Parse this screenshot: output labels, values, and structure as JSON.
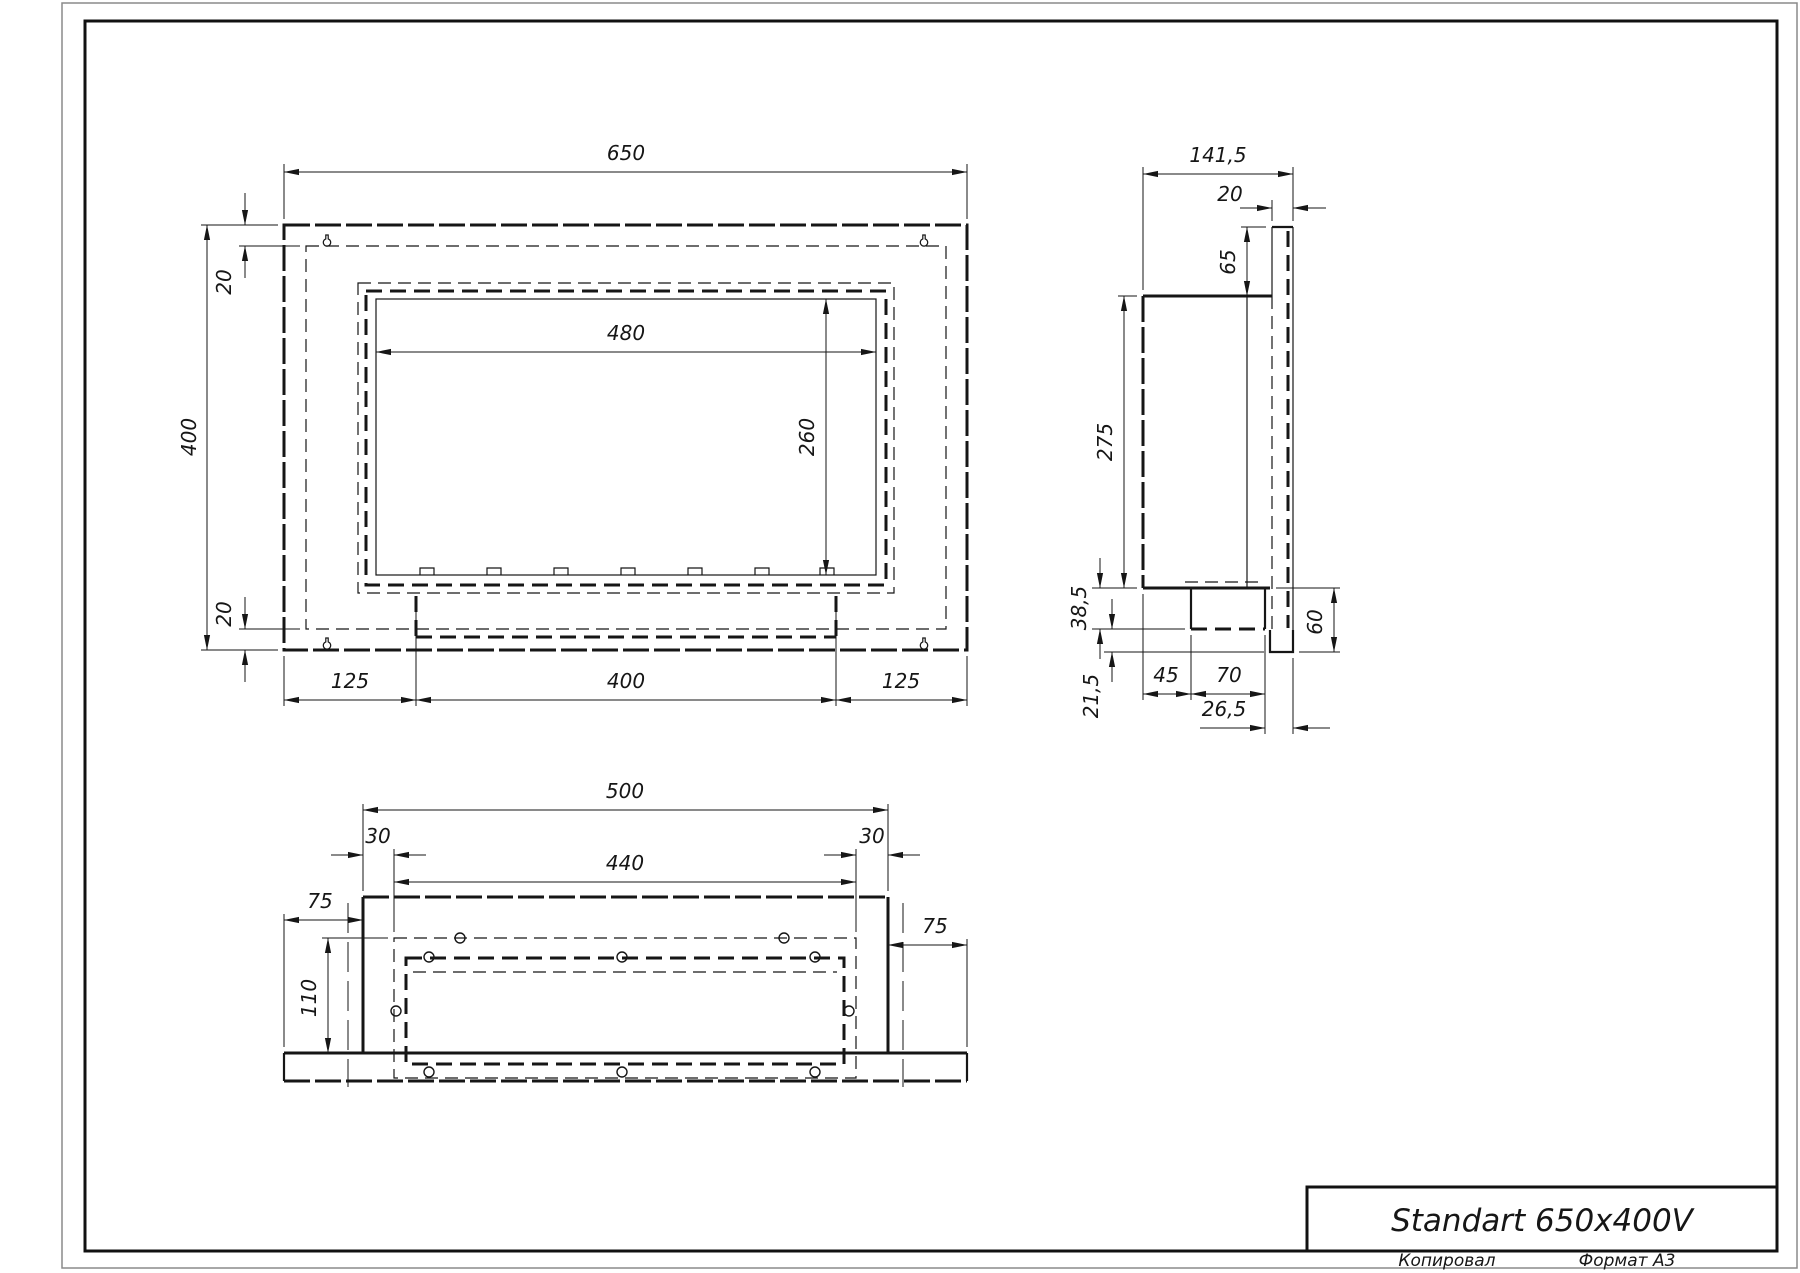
{
  "page": {
    "background": "#ffffff",
    "ink_color": "#161616",
    "icons": {
      "hanger": "keyhole-slot-icon"
    }
  },
  "title_block": {
    "title": "Standart 650x400V",
    "copied_label": "Копировал",
    "format_label": "Формат А3"
  },
  "views": {
    "front": {
      "dims": {
        "width": "650",
        "height": "400",
        "top_offset": "20",
        "bottom_offset": "20",
        "opening_width": "480",
        "opening_height": "260",
        "bottom_left": "125",
        "bottom_center": "400",
        "bottom_right": "125"
      }
    },
    "side": {
      "dims": {
        "depth_total": "141,5",
        "flange_depth": "20",
        "flange_above": "65",
        "body_height": "275",
        "drop_upper": "38,5",
        "drop_lower": "21,5",
        "foot_offset_left": "45",
        "foot_width": "70",
        "foot_to_edge": "26,5",
        "flange_below": "60"
      }
    },
    "bottom": {
      "dims": {
        "housing_width": "500",
        "inset_left": "30",
        "tray_width": "440",
        "inset_right": "30",
        "flange_left": "75",
        "flange_right": "75",
        "depth": "110"
      }
    }
  }
}
